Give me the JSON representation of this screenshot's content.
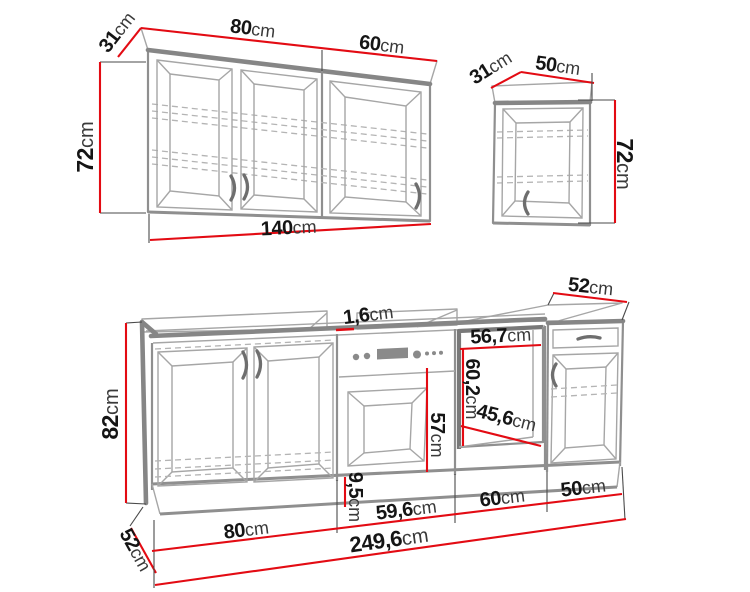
{
  "figure": {
    "description": "Kitchen cabinet set dimension drawing: wall cabinet run, single wall cabinet, and base cabinet run with oven and appliance niche"
  },
  "colors": {
    "dimension_line": "#e30b13",
    "cabinet_edge": "#8f8f8f",
    "text": "#151515"
  },
  "dims": {
    "wall_run_depth": {
      "v": "31",
      "u": "cm"
    },
    "wall_run_door_left": {
      "v": "80",
      "u": "cm"
    },
    "wall_run_door_right": {
      "v": "60",
      "u": "cm"
    },
    "wall_run_height": {
      "v": "72",
      "u": "cm"
    },
    "wall_run_total_width": {
      "v": "140",
      "u": "cm"
    },
    "wall_single_depth": {
      "v": "31",
      "u": "cm"
    },
    "wall_single_width": {
      "v": "50",
      "u": "cm"
    },
    "wall_single_height": {
      "v": "72",
      "u": "cm"
    },
    "worktop_thickness": {
      "v": "1,6",
      "u": "cm"
    },
    "niche_width": {
      "v": "56,7",
      "u": "cm"
    },
    "niche_height": {
      "v": "60,2",
      "u": "cm"
    },
    "niche_depth": {
      "v": "45,6",
      "u": "cm"
    },
    "oven_front_height": {
      "v": "57",
      "u": "cm"
    },
    "base_height": {
      "v": "82",
      "u": "cm"
    },
    "plinth_height": {
      "v": "9,5",
      "u": "cm"
    },
    "base_top_depth": {
      "v": "52",
      "u": "cm"
    },
    "base_side_depth": {
      "v": "52",
      "u": "cm"
    },
    "segment_cabinet": {
      "v": "80",
      "u": "cm"
    },
    "segment_oven": {
      "v": "59,6",
      "u": "cm"
    },
    "segment_niche": {
      "v": "60",
      "u": "cm"
    },
    "segment_drawer_unit": {
      "v": "50",
      "u": "cm"
    },
    "base_total_width": {
      "v": "249,6",
      "u": "cm"
    }
  }
}
